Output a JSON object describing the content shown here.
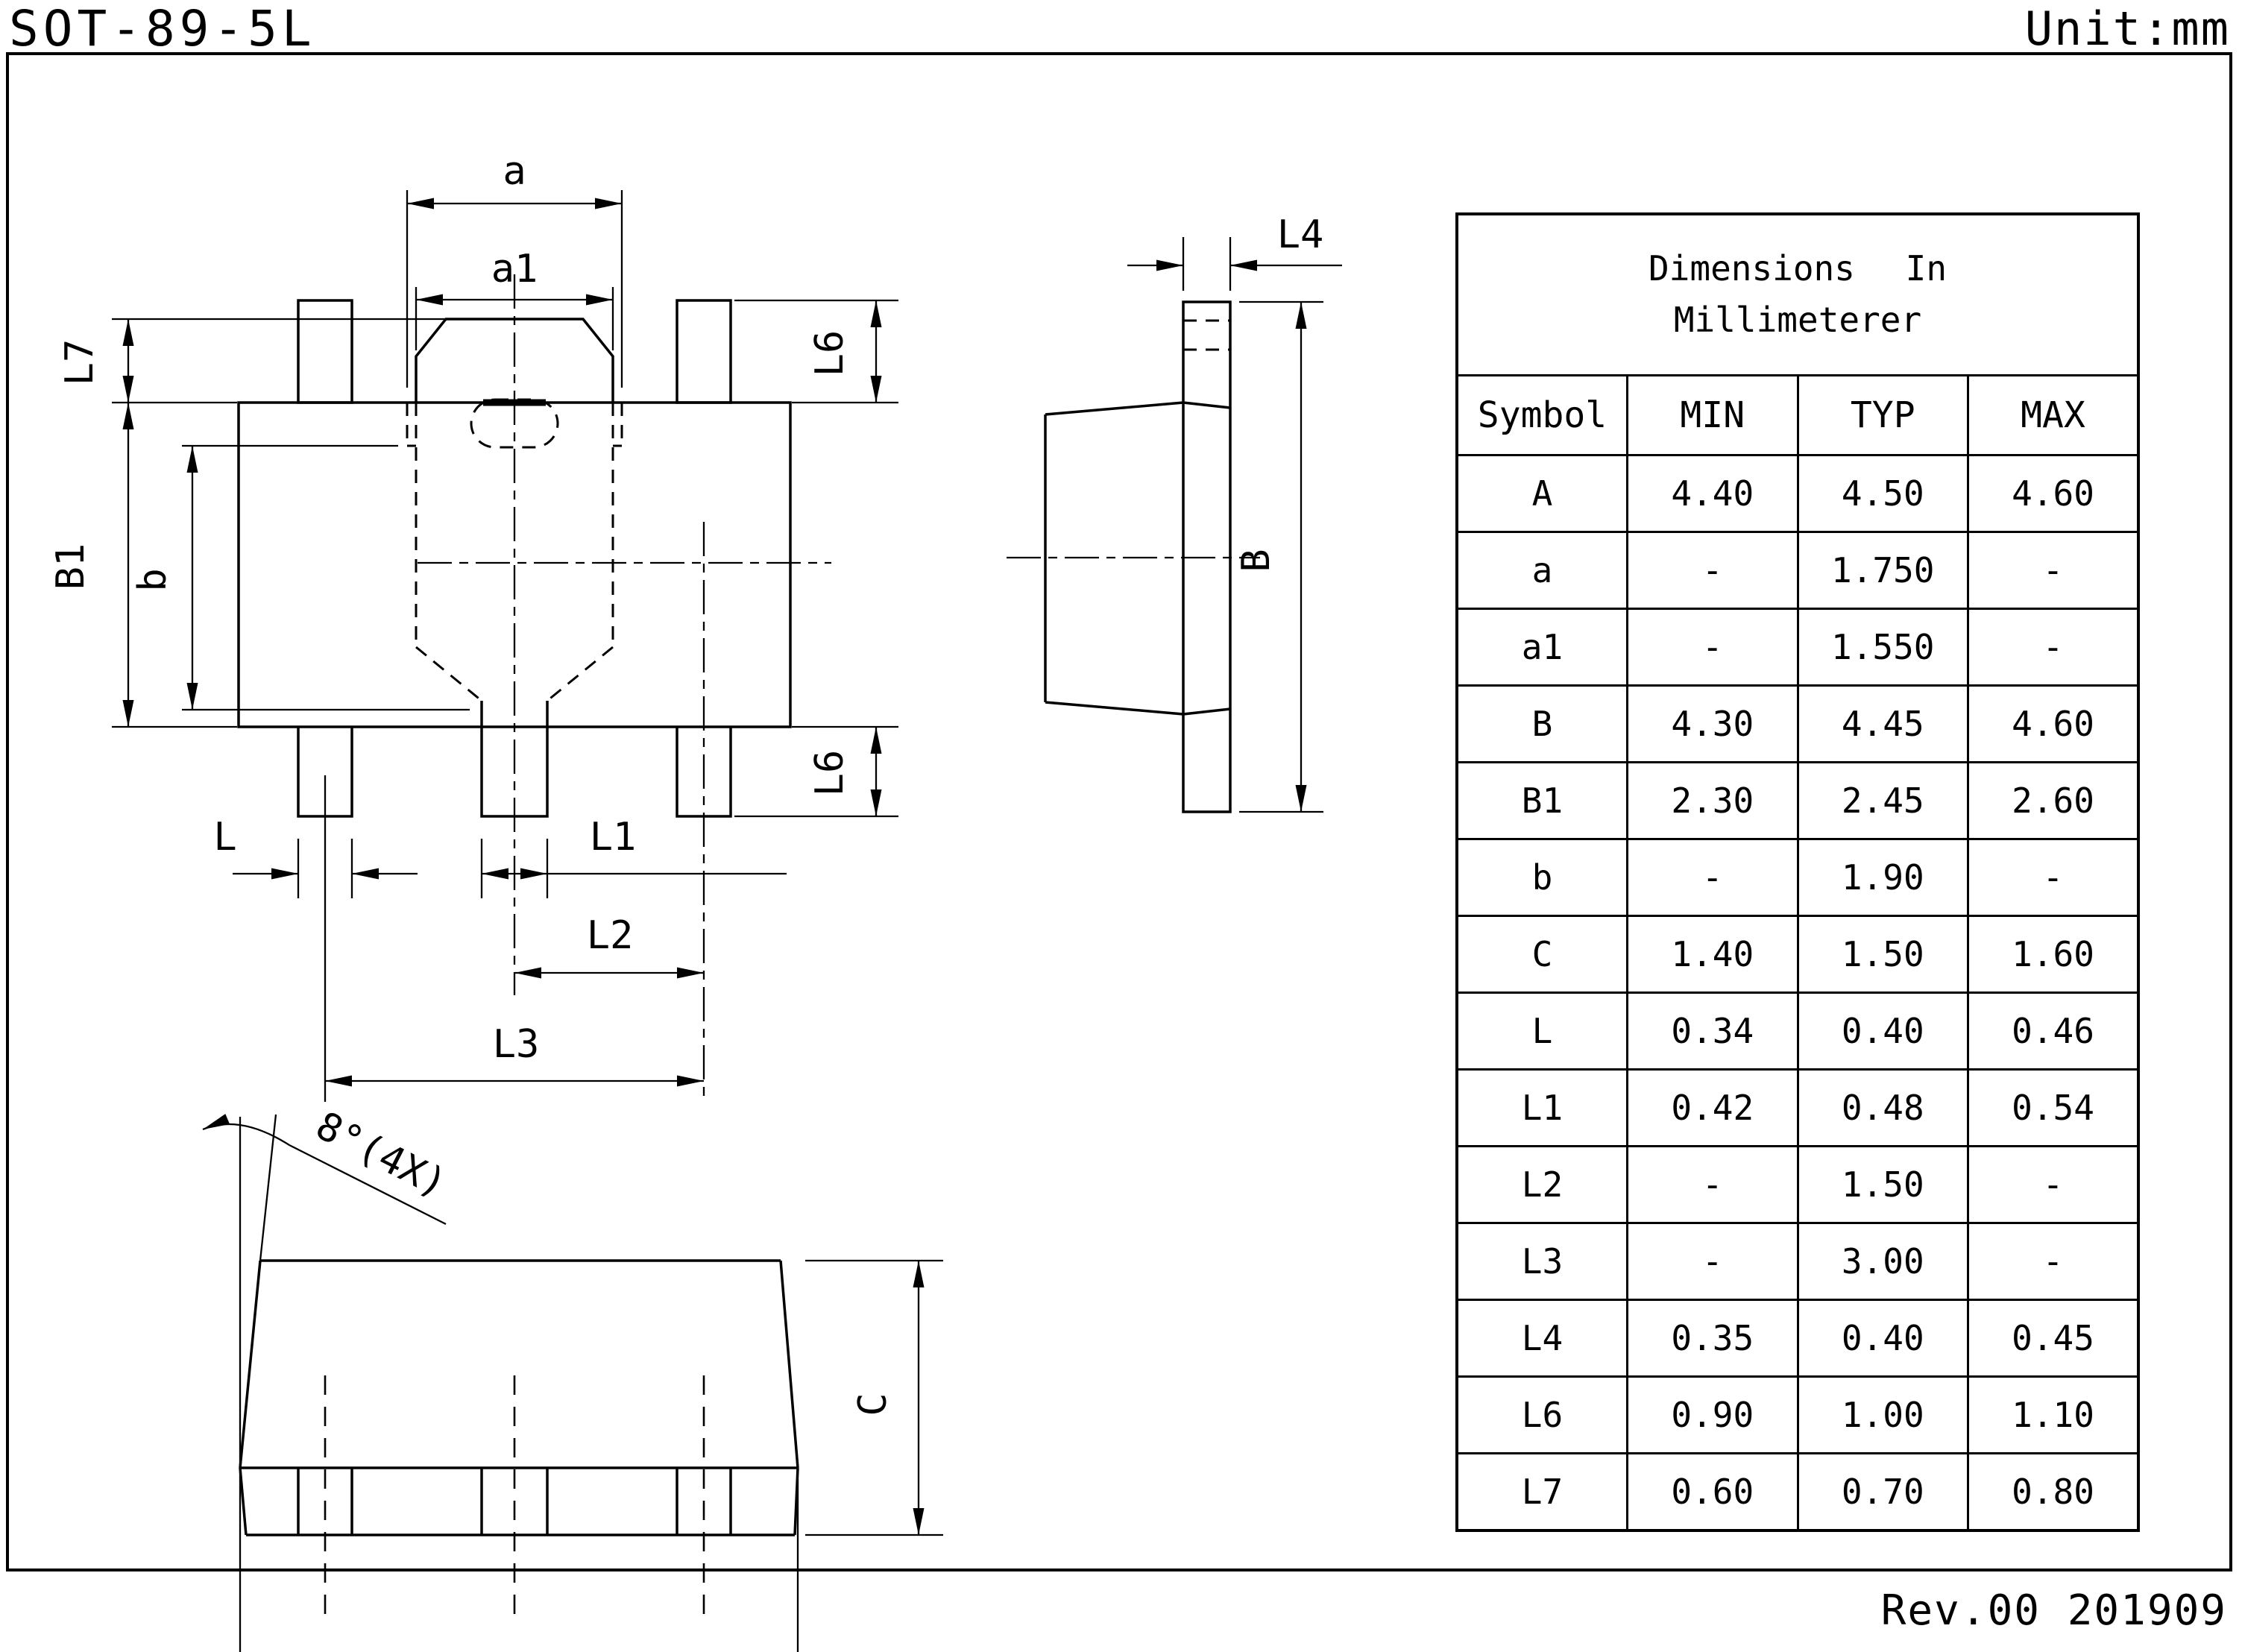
{
  "page": {
    "title": "SOT-89-5L",
    "unit": "Unit:mm",
    "revision": "Rev.00 201909"
  },
  "drawing": {
    "front": {
      "a": "a",
      "a1": "a1",
      "L7": "L7",
      "B1": "B1",
      "b": "b",
      "L6_top": "L6",
      "L6_bottom": "L6",
      "L": "L",
      "L1": "L1",
      "L2": "L2",
      "L3": "L3"
    },
    "side": {
      "L4": "L4",
      "B": "B"
    },
    "bottom": {
      "A": "A",
      "C": "C",
      "angle_note": "8°(4X)"
    }
  },
  "table": {
    "title_line1": "Dimensions In",
    "title_line2": "Millimeterer",
    "columns": {
      "symbol": "Symbol",
      "min": "MIN",
      "typ": "TYP",
      "max": "MAX"
    },
    "rows": [
      {
        "symbol": "A",
        "min": "4.40",
        "typ": "4.50",
        "max": "4.60"
      },
      {
        "symbol": "a",
        "min": "-",
        "typ": "1.750",
        "max": "-"
      },
      {
        "symbol": "a1",
        "min": "-",
        "typ": "1.550",
        "max": "-"
      },
      {
        "symbol": "B",
        "min": "4.30",
        "typ": "4.45",
        "max": "4.60"
      },
      {
        "symbol": "B1",
        "min": "2.30",
        "typ": "2.45",
        "max": "2.60"
      },
      {
        "symbol": "b",
        "min": "-",
        "typ": "1.90",
        "max": "-"
      },
      {
        "symbol": "C",
        "min": "1.40",
        "typ": "1.50",
        "max": "1.60"
      },
      {
        "symbol": "L",
        "min": "0.34",
        "typ": "0.40",
        "max": "0.46"
      },
      {
        "symbol": "L1",
        "min": "0.42",
        "typ": "0.48",
        "max": "0.54"
      },
      {
        "symbol": "L2",
        "min": "-",
        "typ": "1.50",
        "max": "-"
      },
      {
        "symbol": "L3",
        "min": "-",
        "typ": "3.00",
        "max": "-"
      },
      {
        "symbol": "L4",
        "min": "0.35",
        "typ": "0.40",
        "max": "0.45"
      },
      {
        "symbol": "L6",
        "min": "0.90",
        "typ": "1.00",
        "max": "1.10"
      },
      {
        "symbol": "L7",
        "min": "0.60",
        "typ": "0.70",
        "max": "0.80"
      }
    ]
  }
}
